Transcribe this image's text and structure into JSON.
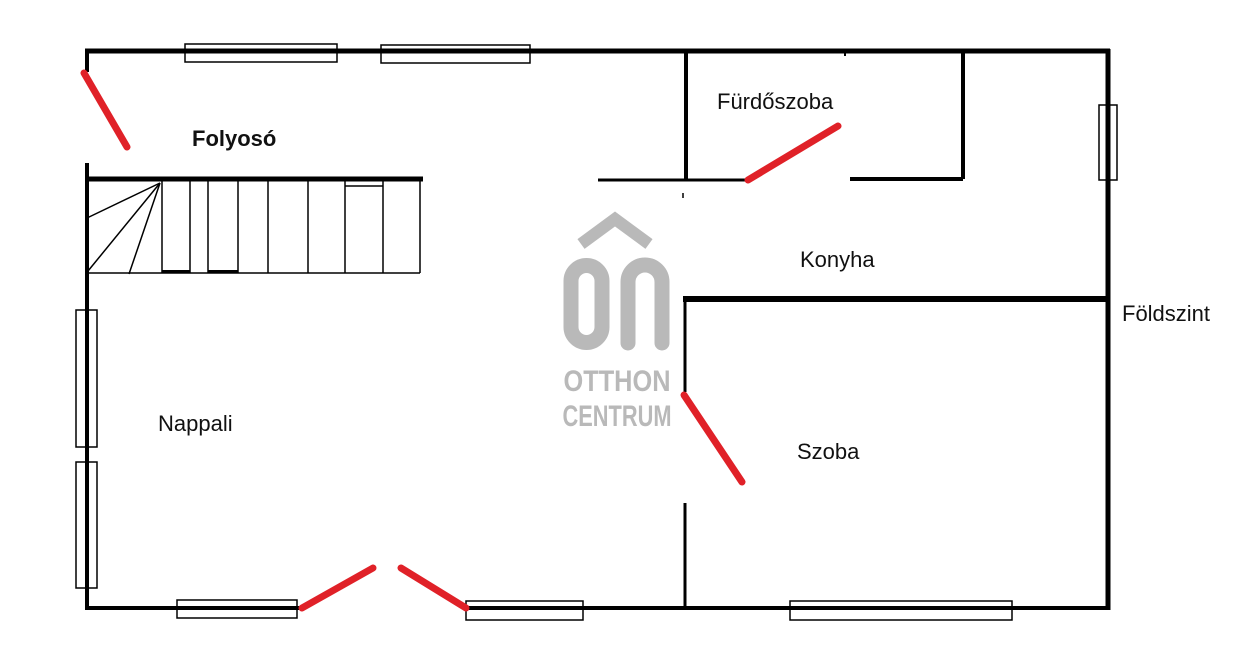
{
  "colors": {
    "background": "#ffffff",
    "wall": "#000000",
    "door_swing": "#e02128",
    "logo": "#b9b9b9",
    "label": "#111111"
  },
  "floorplan": {
    "floor_label": "Földszint",
    "rooms": [
      {
        "name": "Folyosó"
      },
      {
        "name": "Fürdőszoba"
      },
      {
        "name": "Konyha"
      },
      {
        "name": "Nappali"
      },
      {
        "name": "Szoba"
      }
    ],
    "watermark": {
      "monogram": "OC",
      "line1": "OTTHON",
      "line2": "CENTRUM"
    }
  }
}
